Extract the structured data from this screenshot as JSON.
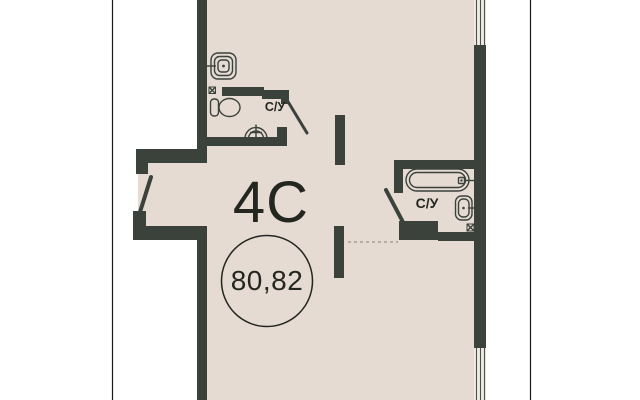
{
  "floorplan": {
    "unit_type": "4С",
    "area": "80,82",
    "bathroom1_label": "С/У",
    "bathroom2_label": "С/У"
  },
  "icons": {
    "toilet": "toilet-top-view",
    "washbasin_square": "square-sink-top-view",
    "corner_sink": "semicircle-sink-with-tap-cross",
    "bathtub": "bathtub-top-view",
    "wall_sink": "wall-mounted-sink-top-view",
    "vent_shaft": "crossed-box-ventilation-shaft",
    "window": "double-line-glazing",
    "door": "diagonal-door-leaf"
  },
  "colors": {
    "background": "#ffffff",
    "floor": "#e5dbd3",
    "wall": "#3a423b",
    "text": "#23271f",
    "frame": "#1a1a1a",
    "window_fill": "#efeae5",
    "window_line": "#4d5249",
    "dashed_line": "#98938a"
  }
}
